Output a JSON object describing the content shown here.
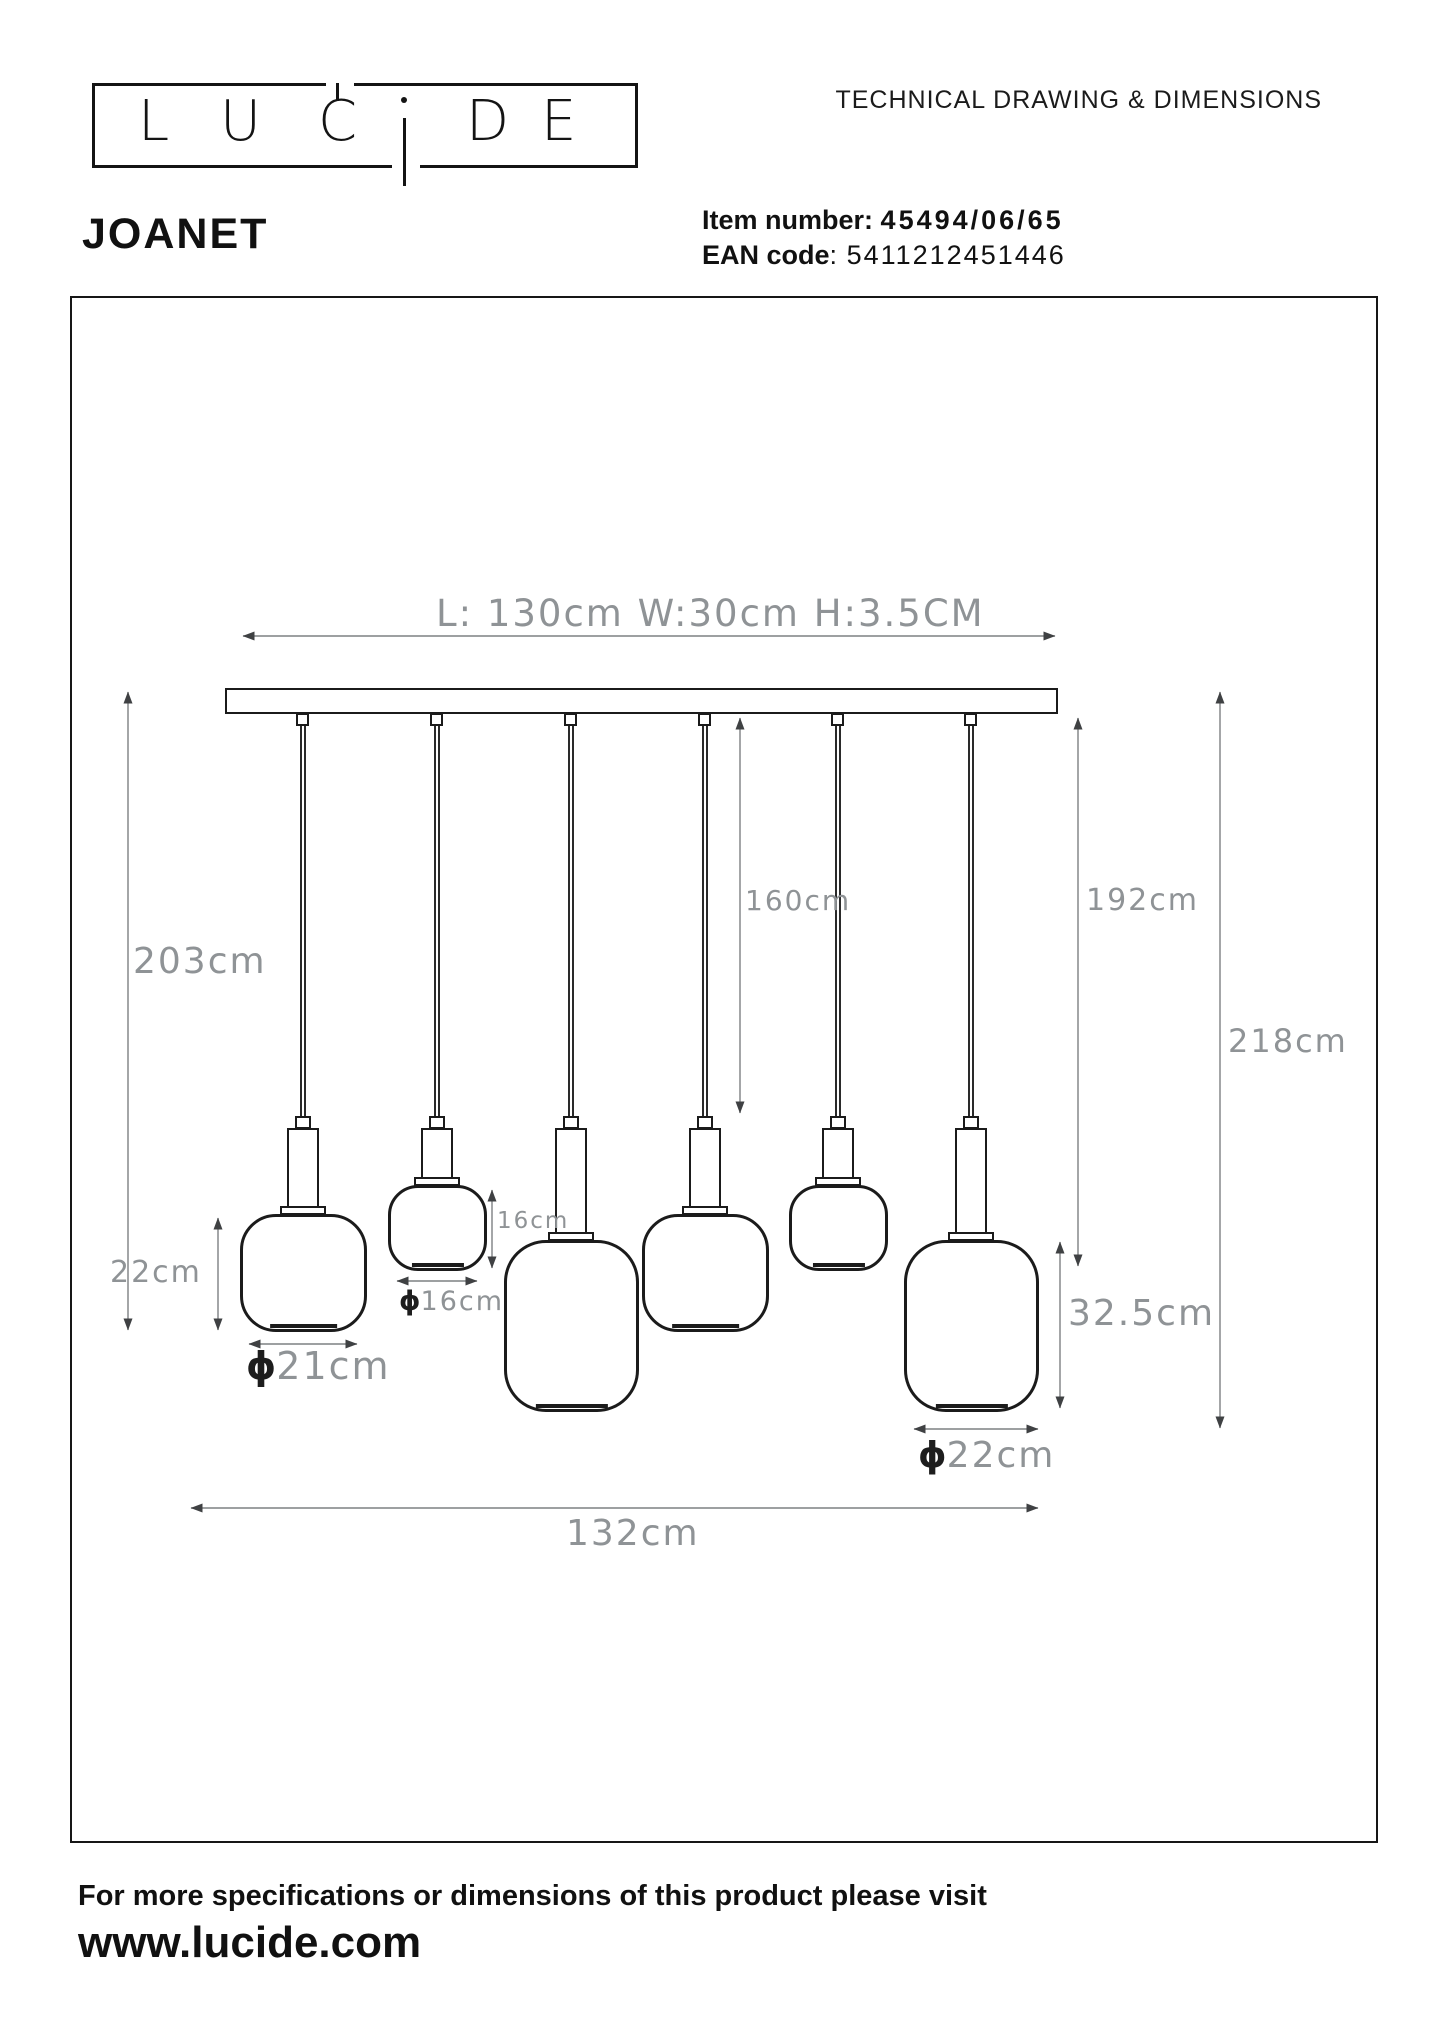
{
  "header": {
    "logo": {
      "letters": [
        "L",
        "U",
        "C",
        "i",
        "D",
        "E"
      ]
    },
    "doc_title": "TECHNICAL DRAWING & DIMENSIONS"
  },
  "product": {
    "name": "JOANET",
    "item_number_label": "Item number:",
    "item_number_value": "45494/06/65",
    "ean_label": "EAN code",
    "ean_separator": ":",
    "ean_value": "5411212451446"
  },
  "drawing": {
    "diameter_symbol": "ϕ",
    "fixture_dimensions": "L: 130cm W:30cm H:3.5CM",
    "dim_drop_left": "203cm",
    "dim_drop_middle": "160cm",
    "dim_drop_right": "192cm",
    "dim_total_height": "218cm",
    "dim_total_width": "132cm",
    "dim_shade_medium_height": "22cm",
    "dim_shade_medium_diameter": "21cm",
    "dim_shade_small_height": "16cm",
    "dim_shade_small_diameter": "16cm",
    "dim_shade_large_height": "32.5cm",
    "dim_shade_large_diameter": "22cm"
  },
  "footer": {
    "note": "For more specifications or dimensions of this product please visit",
    "website": "www.lucide.com"
  },
  "colors": {
    "fixture_line": "#1b1b1b",
    "dimension_line": "#7d8082",
    "dimension_text": "#8f9396"
  }
}
